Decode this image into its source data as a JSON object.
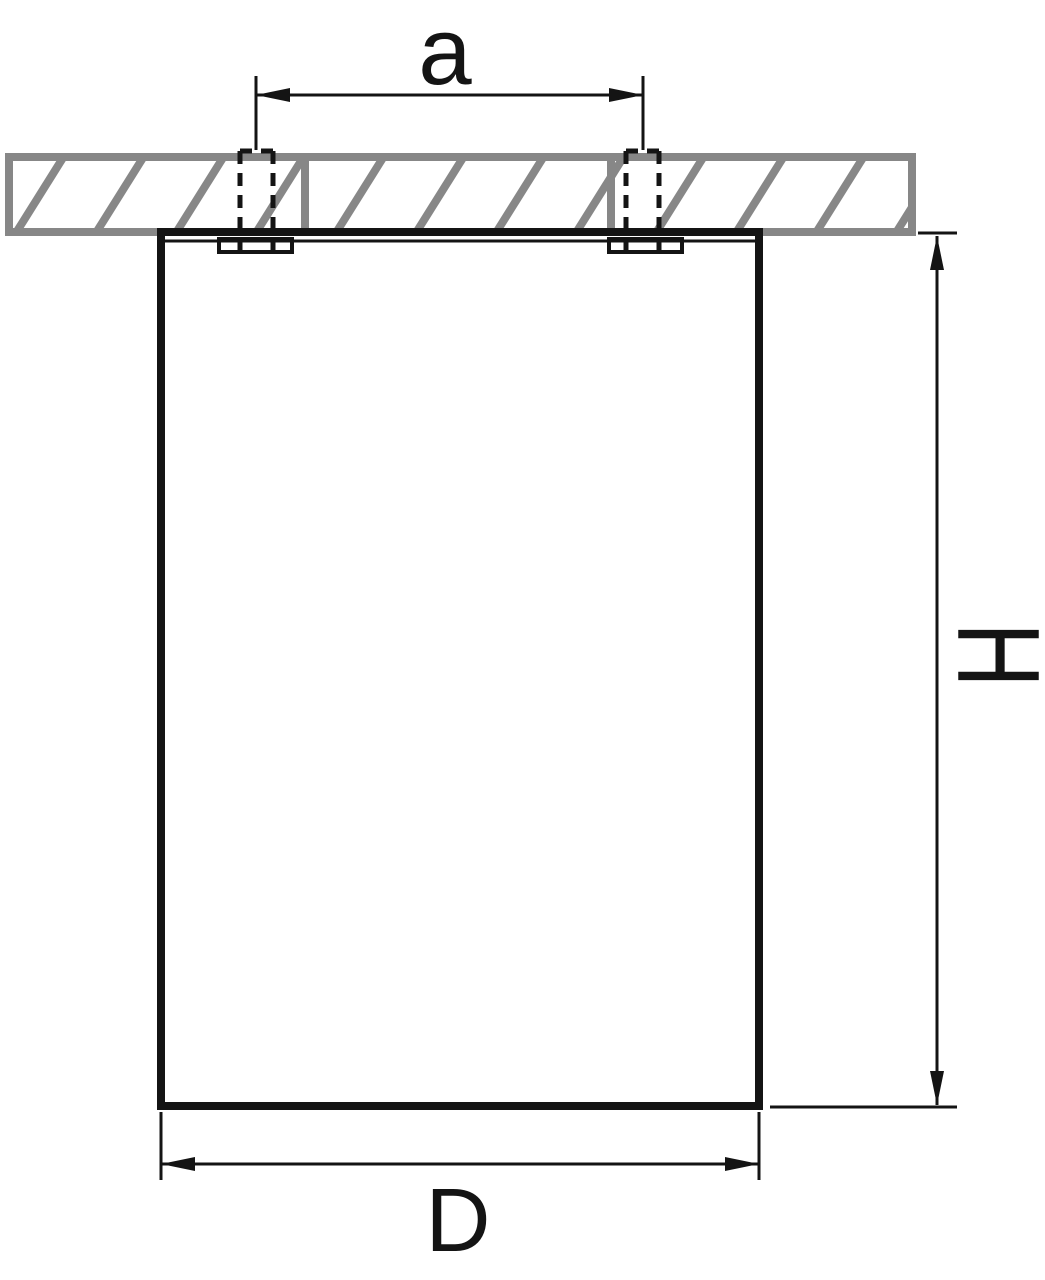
{
  "drawing": {
    "labels": {
      "hole_spacing": "a",
      "height": "H",
      "diameter": "D"
    },
    "colors": {
      "line": "#141414",
      "hatch": "#878787",
      "background": "#ffffff"
    }
  }
}
